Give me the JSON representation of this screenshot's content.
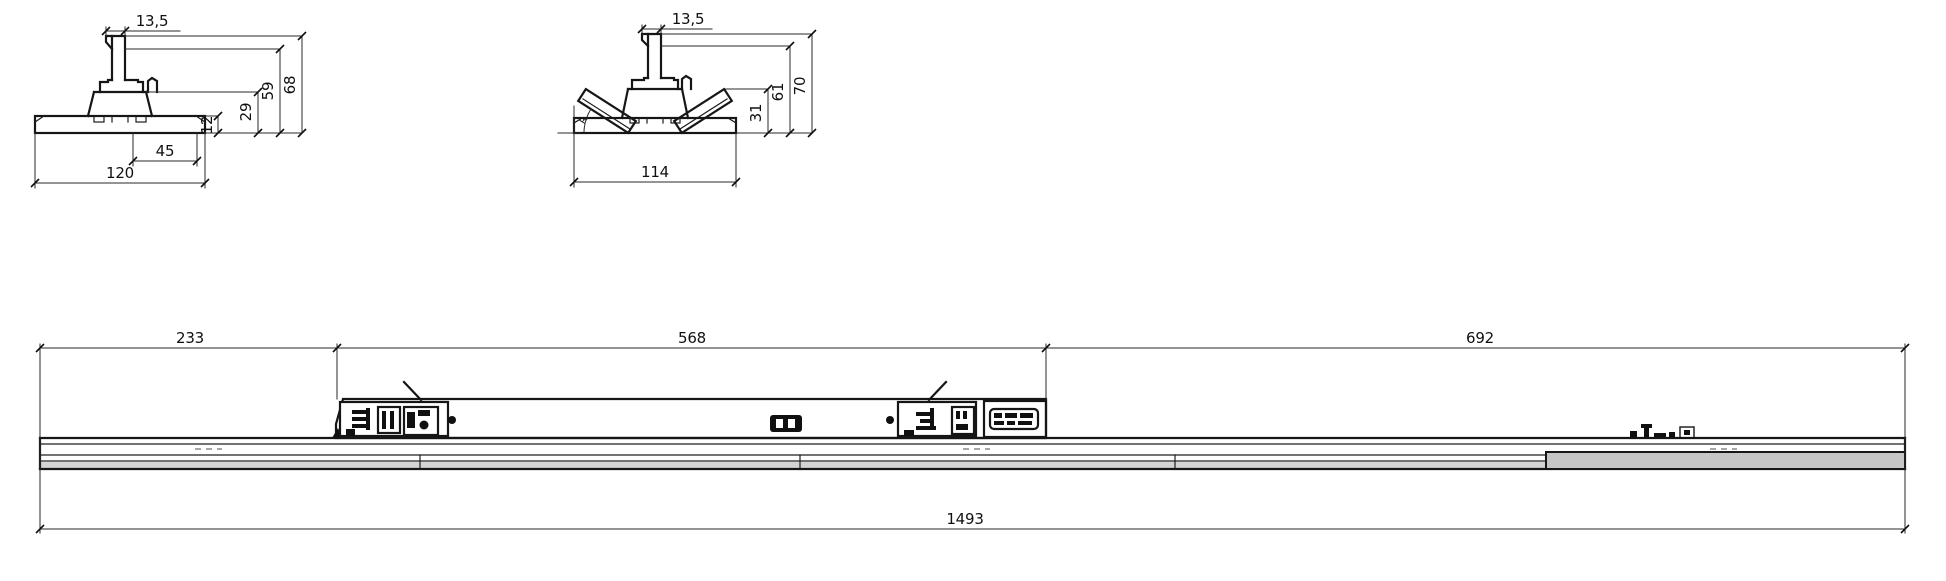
{
  "flat_section": {
    "stem_width": "13,5",
    "total_height": "68",
    "body_height": "59",
    "adapter_height": "29",
    "slot_width": "45",
    "rail_height": "12",
    "base_width": "120"
  },
  "winged_section": {
    "stem_width": "13,5",
    "total_height": "70",
    "body_height": "61",
    "wing_height": "31",
    "base_width": "114",
    "angle_label": "R"
  },
  "side_view": {
    "segment_left": "233",
    "segment_middle": "568",
    "segment_right": "692",
    "overall_length": "1493"
  }
}
